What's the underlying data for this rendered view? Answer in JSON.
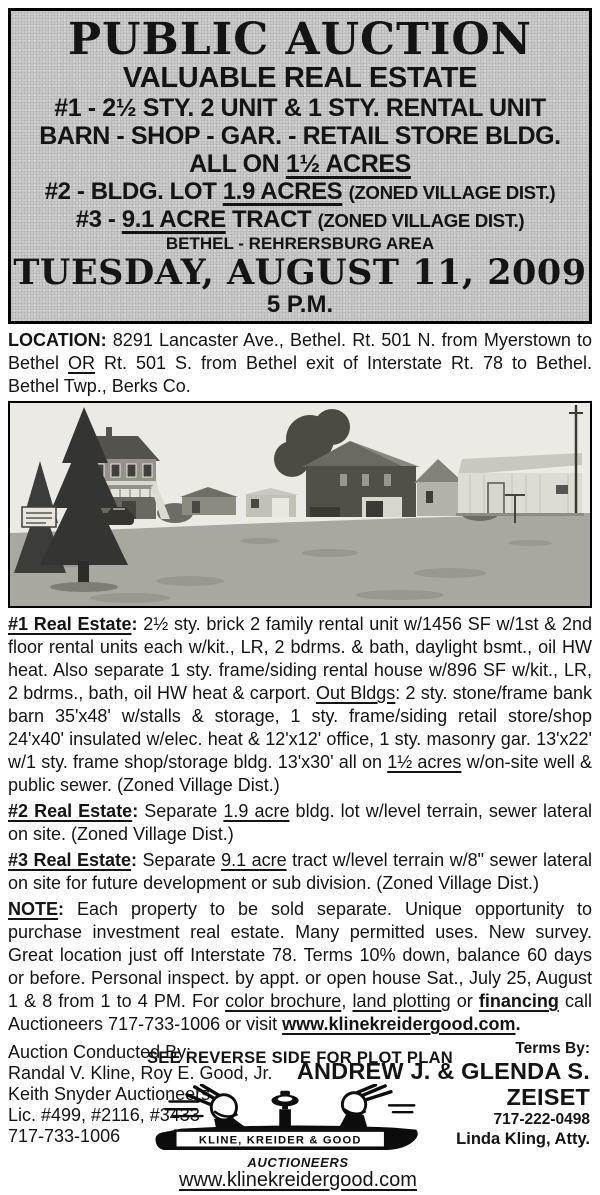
{
  "colors": {
    "header_bg": "#c9c9c9",
    "ink": "#141414",
    "paper": "#ffffff"
  },
  "header": {
    "title": "PUBLIC AUCTION",
    "subtitle": "VALUABLE REAL ESTATE",
    "line1": "#1 - 2½ STY. 2 UNIT & 1 STY. RENTAL UNIT",
    "line2": "BARN - SHOP - GAR. - RETAIL STORE BLDG.",
    "line3": [
      {
        "t": "ALL ON "
      },
      {
        "t": "1½ ACRES",
        "s": "u"
      }
    ],
    "line4": [
      {
        "t": "#2 - BLDG. LOT "
      },
      {
        "t": "1.9 ACRES",
        "s": "u"
      },
      {
        "t": " "
      },
      {
        "t": "(ZONED VILLAGE DIST.)",
        "s": "m"
      }
    ],
    "line5": [
      {
        "t": "#3 - "
      },
      {
        "t": "9.1 ACRE",
        "s": "u"
      },
      {
        "t": " TRACT "
      },
      {
        "t": "(ZONED VILLAGE DIST.)",
        "s": "m"
      }
    ],
    "area": "BETHEL - REHRERSBURG AREA",
    "date": "TUESDAY, AUGUST 11, 2009",
    "time": "5 P.M."
  },
  "location": [
    {
      "t": "LOCATION: ",
      "s": "b"
    },
    {
      "t": "8291 Lancaster Ave., Bethel. Rt. 501 N. from Myerstown to Bethel "
    },
    {
      "t": "OR",
      "s": "u"
    },
    {
      "t": " Rt. 501 S. from Bethel exit of Interstate Rt. 78 to Bethel. Bethel Twp., Berks Co."
    }
  ],
  "paragraphs": {
    "p1": [
      {
        "t": "#1 Real Estate",
        "s": "bu"
      },
      {
        "t": ": ",
        "s": "b"
      },
      {
        "t": "2½ sty. brick 2 family rental unit w/1456 SF w/1st & 2nd floor rental units each w/kit., LR, 2 bdrms. & bath, daylight bsmt., oil HW heat. Also separate 1 sty. frame/siding rental house w/896 SF w/kit., LR, 2 bdrms., bath, oil HW heat & carport. "
      },
      {
        "t": "Out Bldgs",
        "s": "u"
      },
      {
        "t": ": 2 sty. stone/frame bank barn 35'x48' w/stalls & storage, 1 sty. frame/siding retail store/shop 24'x40' insulated w/elec. heat & 12'x12' office, 1 sty. masonry gar. 13'x22' w/1 sty. frame shop/storage bldg. 13'x30' all on "
      },
      {
        "t": "1½ acres",
        "s": "u"
      },
      {
        "t": " w/on-site well & public sewer. (Zoned Village Dist.)"
      }
    ],
    "p2": [
      {
        "t": "#2 Real Estate",
        "s": "bu"
      },
      {
        "t": ": ",
        "s": "b"
      },
      {
        "t": "Separate "
      },
      {
        "t": "1.9 acre",
        "s": "u"
      },
      {
        "t": " bldg. lot w/level terrain, sewer lateral on site. (Zoned Village Dist.)"
      }
    ],
    "p3": [
      {
        "t": "#3 Real Estate",
        "s": "bu"
      },
      {
        "t": ": ",
        "s": "b"
      },
      {
        "t": "Separate "
      },
      {
        "t": "9.1 acre",
        "s": "u"
      },
      {
        "t": " tract w/level terrain w/8\" sewer lateral on site for future development or sub division. (Zoned Village Dist.)"
      }
    ],
    "note": [
      {
        "t": "NOTE",
        "s": "bu"
      },
      {
        "t": ": ",
        "s": "b"
      },
      {
        "t": "Each property to be sold separate. Unique opportunity to purchase investment real estate. Many permitted uses. New survey. Great location just off Interstate 78. Terms 10% down, balance 60 days or before. Personal inspect. by appt. or open house Sat., July 25, August 1 & 8 from 1 to 4 PM. For "
      },
      {
        "t": "color brochure",
        "s": "u"
      },
      {
        "t": ", "
      },
      {
        "t": "land plotting",
        "s": "u"
      },
      {
        "t": " or "
      },
      {
        "t": "financing",
        "s": "bu"
      },
      {
        "t": " call Auctioneers 717-733-1006 or visit "
      },
      {
        "t": "www.klinekreidergood.com",
        "s": "bu"
      },
      {
        "t": ".",
        "s": "b"
      }
    ]
  },
  "reverse_note": "SEE REVERSE SIDE FOR PLOT PLAN",
  "footer": {
    "conducted_by": [
      "Auction Conducted By:",
      "Randal V. Kline, Roy E. Good, Jr.",
      "Keith Snyder Auctioneers",
      "Lic. #499, #2116, #3433",
      "717-733-1006"
    ],
    "terms_label": "Terms By:",
    "terms_line1": "ANDREW J. & GLENDA S.",
    "terms_line2": "ZEISET",
    "terms_phone": "717-222-0498",
    "terms_attorney": "Linda Kling, Atty.",
    "logo_text": "KLINE, KREIDER & GOOD",
    "logo_subtext": "AUCTIONEERS",
    "website": "www.klinekreidergood.com"
  }
}
